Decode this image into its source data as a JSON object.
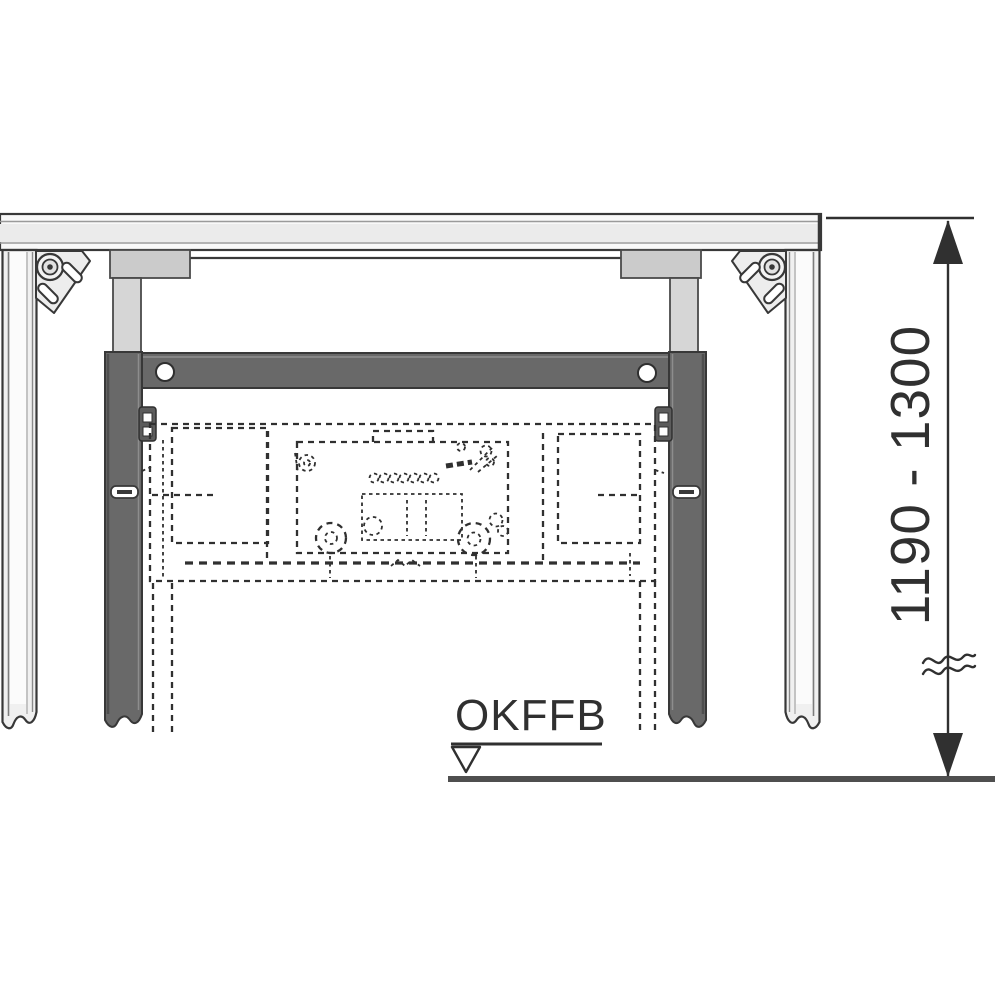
{
  "labels": {
    "floor_reference": "OKFFB",
    "height_range": "1190 - 1300"
  },
  "colors": {
    "background": "#ffffff",
    "ink": "#303030",
    "frame_fill": "#f0f0f0",
    "frame_band": "#ebebeb",
    "frame_bright": "#fbfbfb",
    "hanger_fill": "#cbcbcb",
    "bar_fill": "#d6d6d6",
    "rail_fill": "#696969",
    "rail_edge": "#383838",
    "clip_fill": "#5c5c5c",
    "floor": "#4f4f4f"
  }
}
